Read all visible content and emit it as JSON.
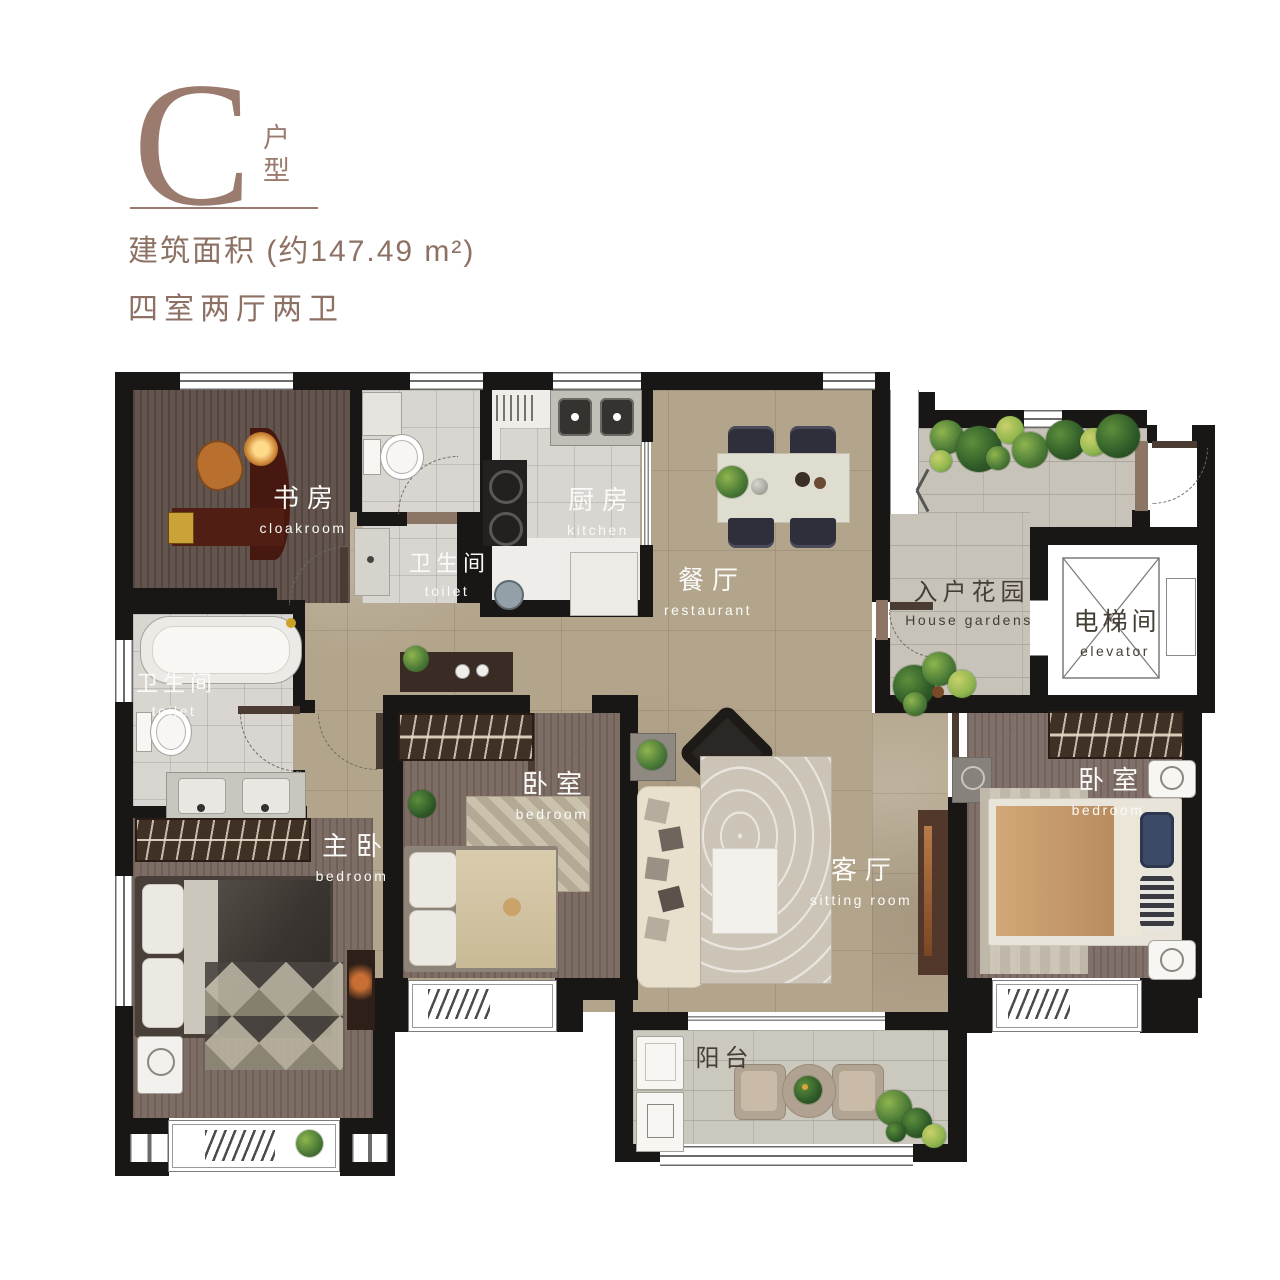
{
  "header": {
    "type_letter": "C",
    "type_label_vertical": "户型",
    "area_line": "建筑面积 (约147.49 m²)",
    "layout_line": "四室两厅两卫",
    "accent_color": "#9b7b6e"
  },
  "rooms": [
    {
      "id": "study",
      "zh": "书房",
      "en": "cloakroom"
    },
    {
      "id": "toilet-top",
      "zh": "卫生间",
      "en": "toilet"
    },
    {
      "id": "kitchen",
      "zh": "厨房",
      "en": "kitchen"
    },
    {
      "id": "dining",
      "zh": "餐厅",
      "en": "restaurant"
    },
    {
      "id": "entry-garden",
      "zh": "入户花园",
      "en": "House gardens"
    },
    {
      "id": "elevator",
      "zh": "电梯间",
      "en": "elevator"
    },
    {
      "id": "toilet-left",
      "zh": "卫生间",
      "en": "toilet"
    },
    {
      "id": "master-bedroom",
      "zh": "主卧",
      "en": "bedroom"
    },
    {
      "id": "bedroom-middle",
      "zh": "卧室",
      "en": "bedroom"
    },
    {
      "id": "living-room",
      "zh": "客厅",
      "en": "sitting room"
    },
    {
      "id": "bedroom-right",
      "zh": "卧室",
      "en": "bedroom"
    },
    {
      "id": "balcony",
      "zh": "阳台",
      "en": ""
    }
  ]
}
